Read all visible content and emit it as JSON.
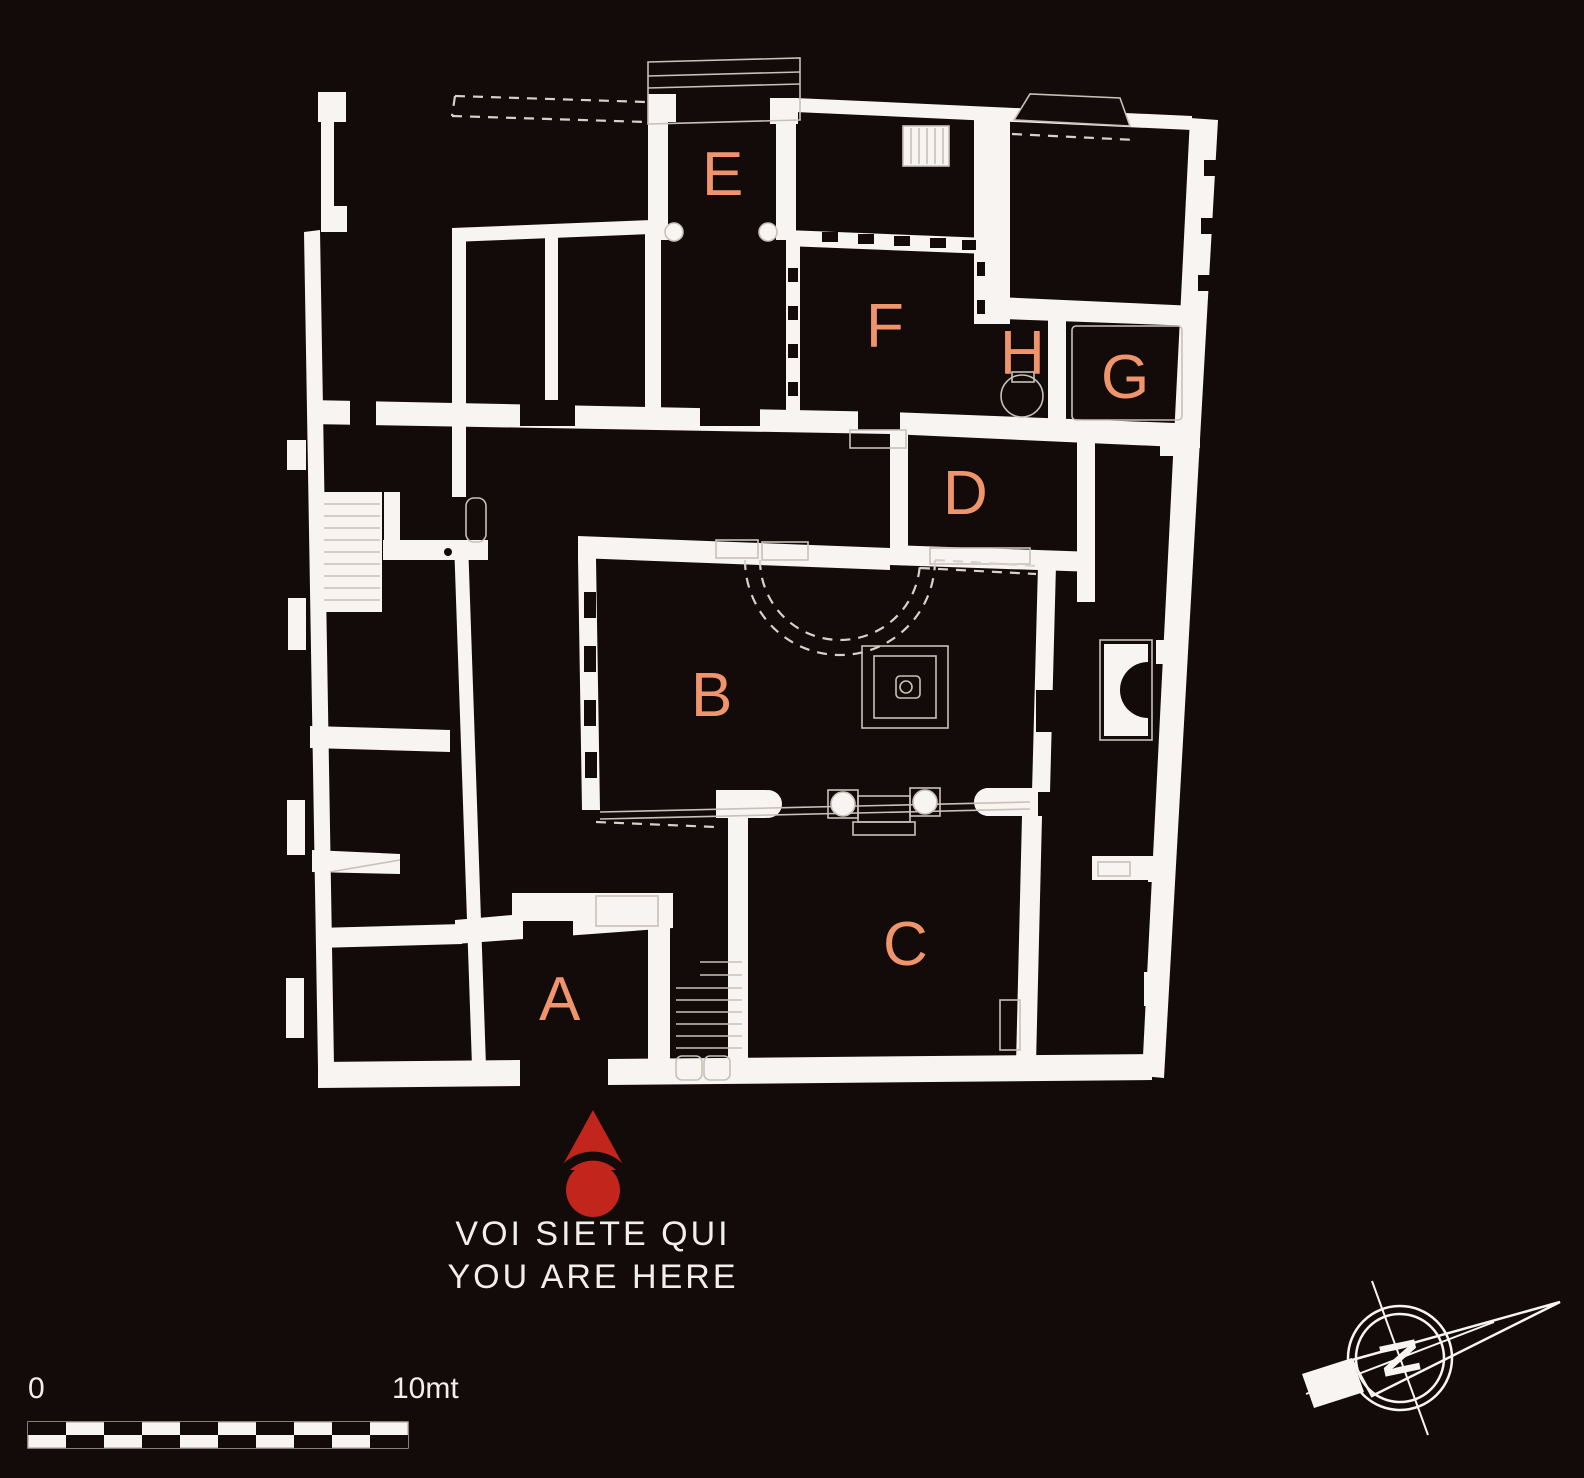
{
  "map": {
    "title": "archaeological-house-floor-plan",
    "colors": {
      "background": "#120b09",
      "wall": "#f7f4f1",
      "room_label": "#f0956b",
      "marker_red": "#c1251b",
      "text": "#f2eeec"
    },
    "rooms": [
      {
        "label": "A"
      },
      {
        "label": "B"
      },
      {
        "label": "C"
      },
      {
        "label": "D"
      },
      {
        "label": "E"
      },
      {
        "label": "F"
      },
      {
        "label": "G"
      },
      {
        "label": "H"
      }
    ]
  },
  "marker": {
    "line1": "VOI SIETE QUI",
    "line2": "YOU ARE HERE",
    "color": "#c1251b"
  },
  "scale_bar": {
    "start_label": "0",
    "end_label": "10mt",
    "segments": 10
  },
  "compass": {
    "north_label": "N"
  }
}
